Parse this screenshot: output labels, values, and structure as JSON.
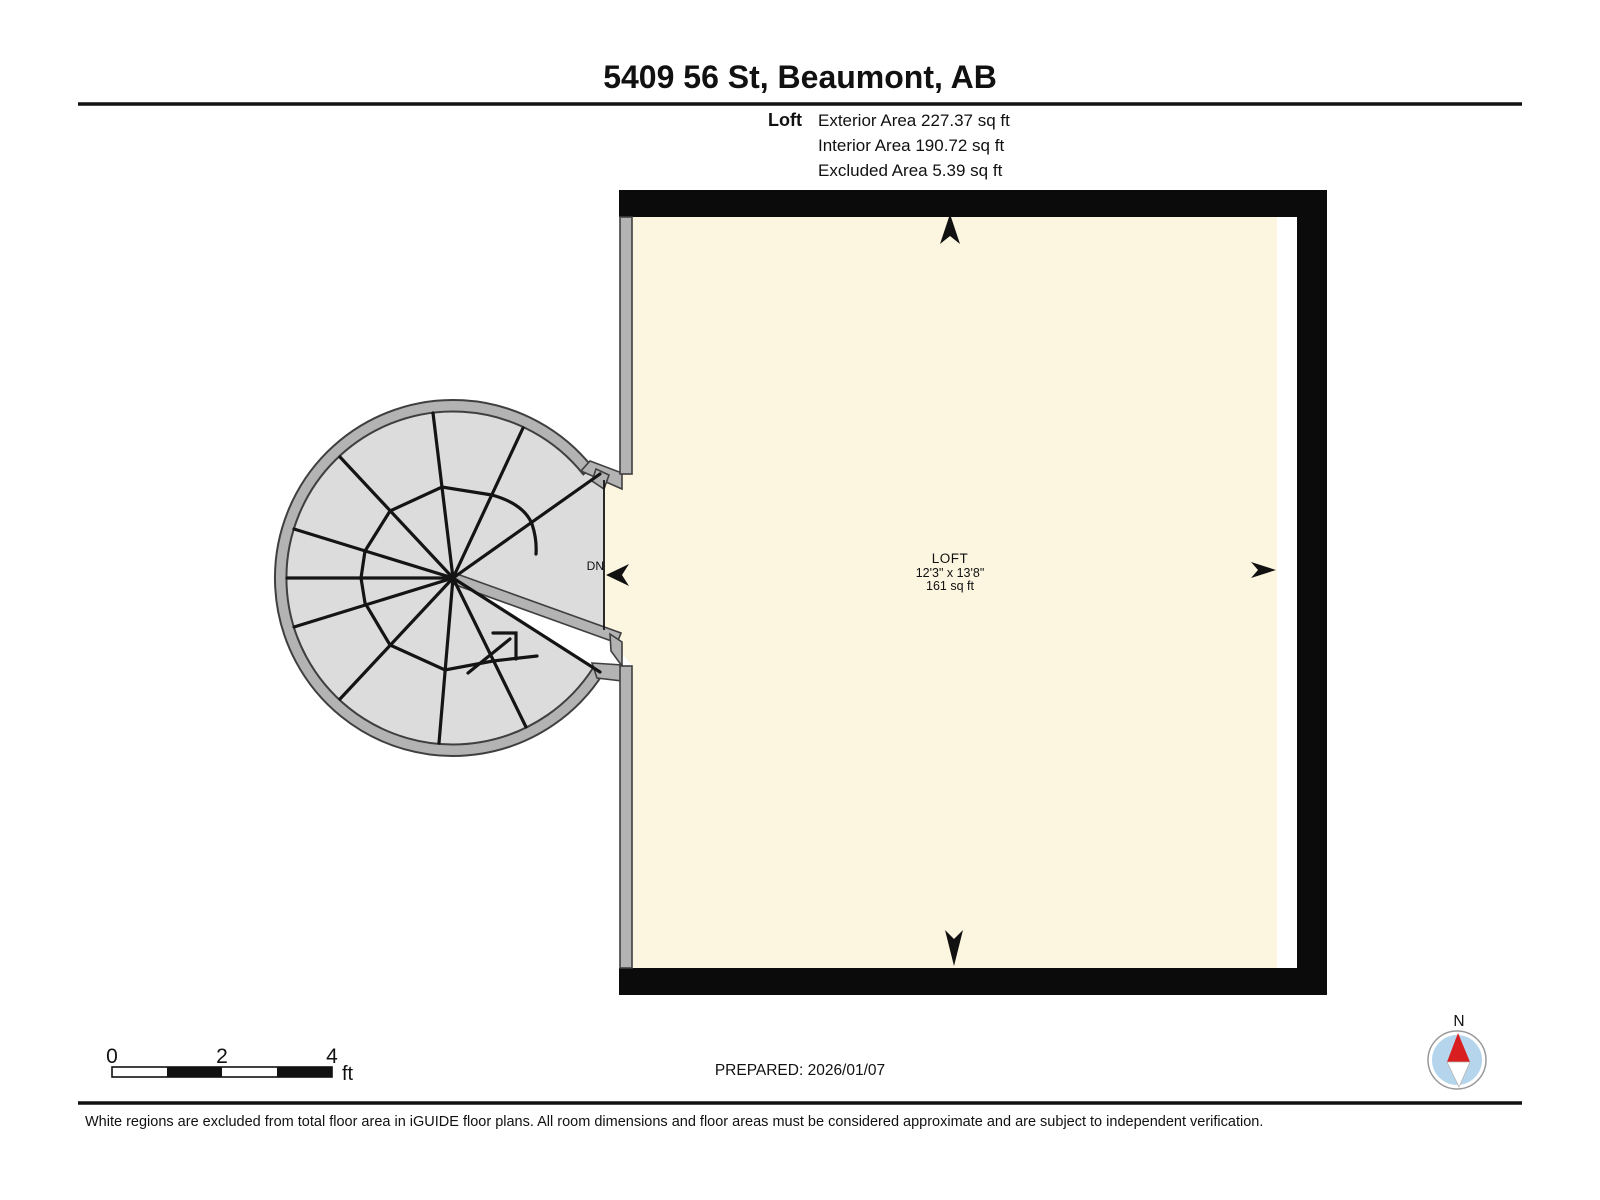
{
  "header": {
    "title": "5409 56 St, Beaumont, AB",
    "floor_label": "Loft",
    "area_lines": [
      "Exterior Area 227.37 sq ft",
      "Interior Area 190.72 sq ft",
      "Excluded Area 5.39 sq ft"
    ]
  },
  "plan": {
    "room": {
      "name": "LOFT",
      "dimensions": "12'3\" x 13'8\"",
      "area": "161 sq ft"
    },
    "stairs_label": "DN",
    "scale": {
      "ticks": [
        "0",
        "2",
        "4"
      ],
      "unit": "ft"
    }
  },
  "footer": {
    "prepared": "PREPARED: 2026/01/07",
    "disclaimer": "White regions are excluded from total floor area in iGUIDE floor plans. All room dimensions and floor areas must be considered approximate and are subject to independent verification.",
    "compass_label": "N"
  },
  "colors": {
    "wall_black": "#0b0b0b",
    "interior_cream": "#fcf5df",
    "excluded_white": "#ffffff",
    "stair_fill": "#dcdcdc",
    "stair_wall_gray": "#b3b3b3",
    "marker_black": "#111111",
    "compass_blue": "#b5d5ec",
    "compass_red": "#d81e1e"
  }
}
